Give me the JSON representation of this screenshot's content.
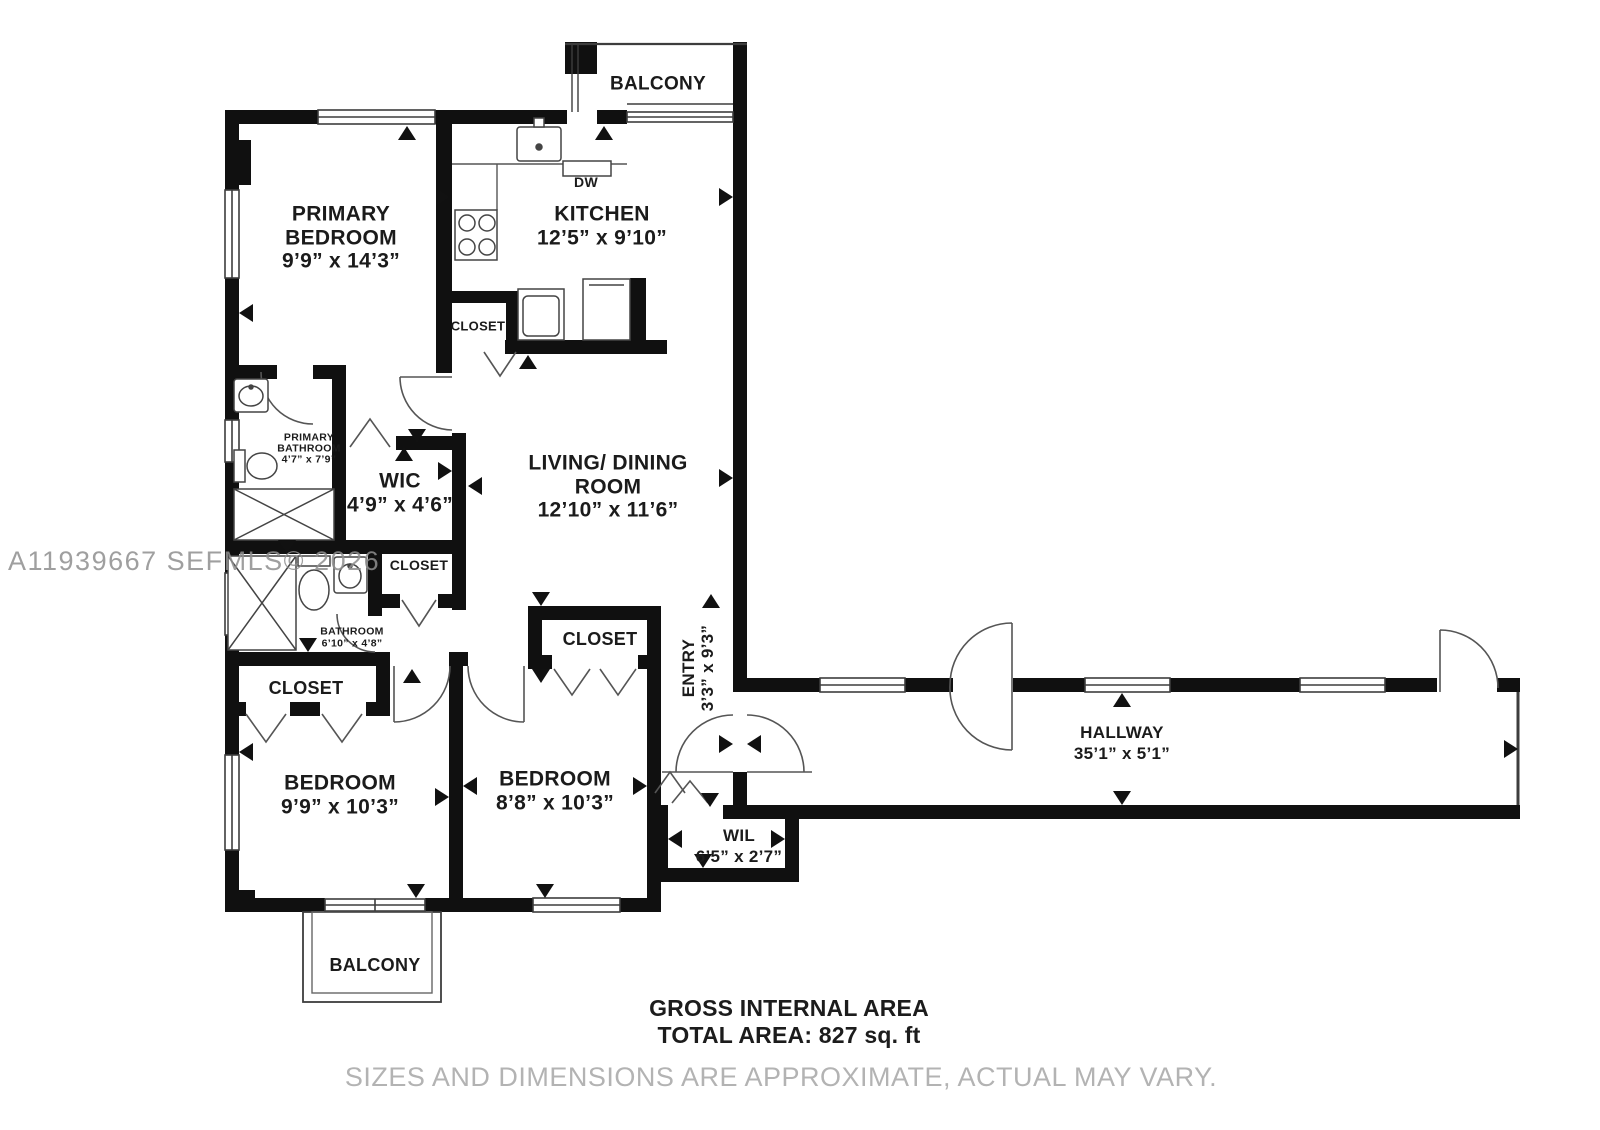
{
  "watermark": "A11939667  SEFMLS© 2026",
  "rooms": {
    "balcony_top": {
      "name": "BALCONY"
    },
    "primary_bedroom": {
      "name": "PRIMARY BEDROOM",
      "dims": "9’9” x 14’3”"
    },
    "kitchen": {
      "name": "KITCHEN",
      "dims": "12’5” x 9’10”"
    },
    "dishwasher": {
      "name": "DW"
    },
    "closet_kitchen": {
      "name": "CLOSET"
    },
    "primary_bathroom": {
      "name": "PRIMARY BATHROOM",
      "dims": "4’7” x 7’9”"
    },
    "wic": {
      "name": "WIC",
      "dims": "4’9” x 4’6”"
    },
    "closet_middle": {
      "name": "CLOSET"
    },
    "bathroom": {
      "name": "BATHROOM",
      "dims": "6’10” x 4’8”"
    },
    "closet_bedroom_left": {
      "name": "CLOSET"
    },
    "living_dining": {
      "name": "LIVING/ DINING ROOM",
      "dims": "12’10” x 11’6”"
    },
    "entry": {
      "name": "ENTRY",
      "dims": "3’3” x 9’3”"
    },
    "closet_bedroom_right": {
      "name": "CLOSET"
    },
    "bedroom_left": {
      "name": "BEDROOM",
      "dims": "9’9” x 10’3”"
    },
    "bedroom_right": {
      "name": "BEDROOM",
      "dims": "8’8” x 10’3”"
    },
    "wil": {
      "name": "WIL",
      "dims": "6’5” x 2’7”"
    },
    "hallway": {
      "name": "HALLWAY",
      "dims": "35’1” x 5’1”"
    },
    "balcony_bottom": {
      "name": "BALCONY"
    }
  },
  "footer": {
    "area_title": "GROSS INTERNAL AREA",
    "area_value": "TOTAL AREA: 827 sq. ft",
    "disclaimer": "SIZES AND DIMENSIONS ARE APPROXIMATE, ACTUAL MAY VARY."
  },
  "colors": {
    "wall": "#101010",
    "label": "#1b1b1b",
    "watermark": "#8f8f8f",
    "disclaimer": "#b3b3b3"
  }
}
